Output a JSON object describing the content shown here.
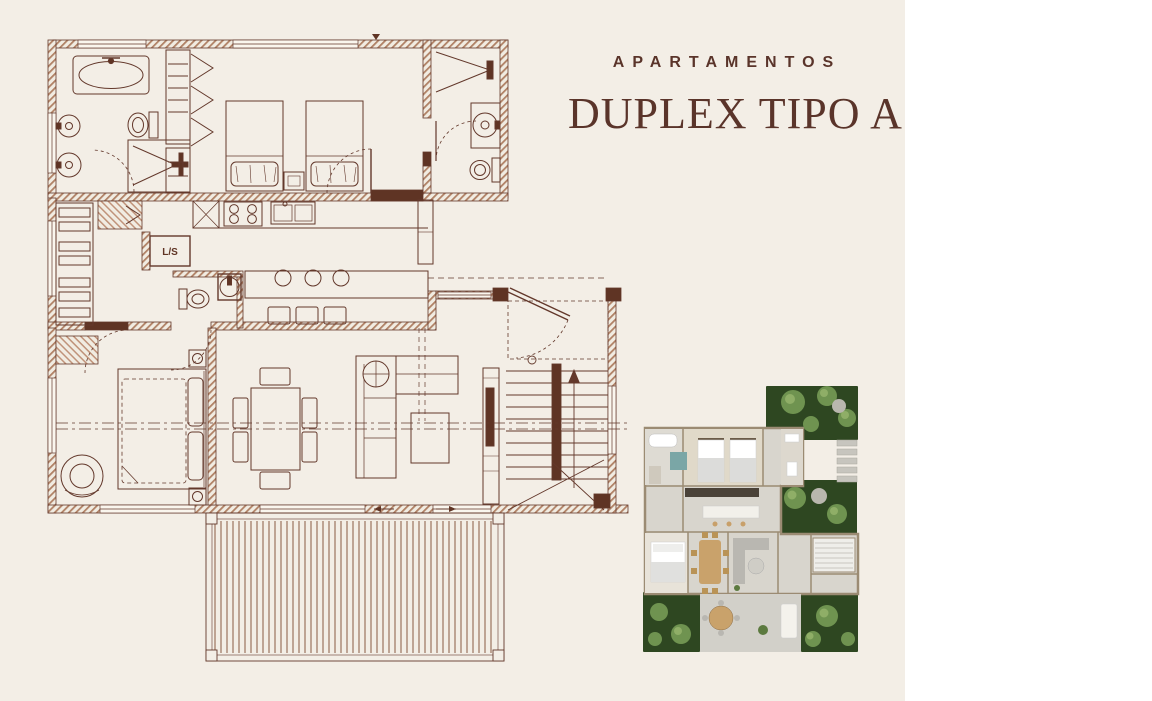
{
  "page": {
    "background": "#ffffff",
    "sheet_background": "#f3eee6"
  },
  "title_block": {
    "eyebrow": "APARTAMENTOS",
    "title": "DUPLEX TIPO A",
    "text_color": "#5a342a"
  },
  "floor_plan": {
    "ink_color": "#63382b",
    "wall_hatch_color": "#b08165",
    "solid_wall_color": "#5f3424",
    "labels": {
      "laundry": "L/S"
    }
  },
  "render_plan": {
    "floor_color": "#d8d5cd",
    "wall_color": "#9b8b73",
    "garden_color": "#2e4721",
    "tree_color": "#6f9350",
    "wood_color": "#c9a26b",
    "shower_teal": "#7aa6a6"
  }
}
